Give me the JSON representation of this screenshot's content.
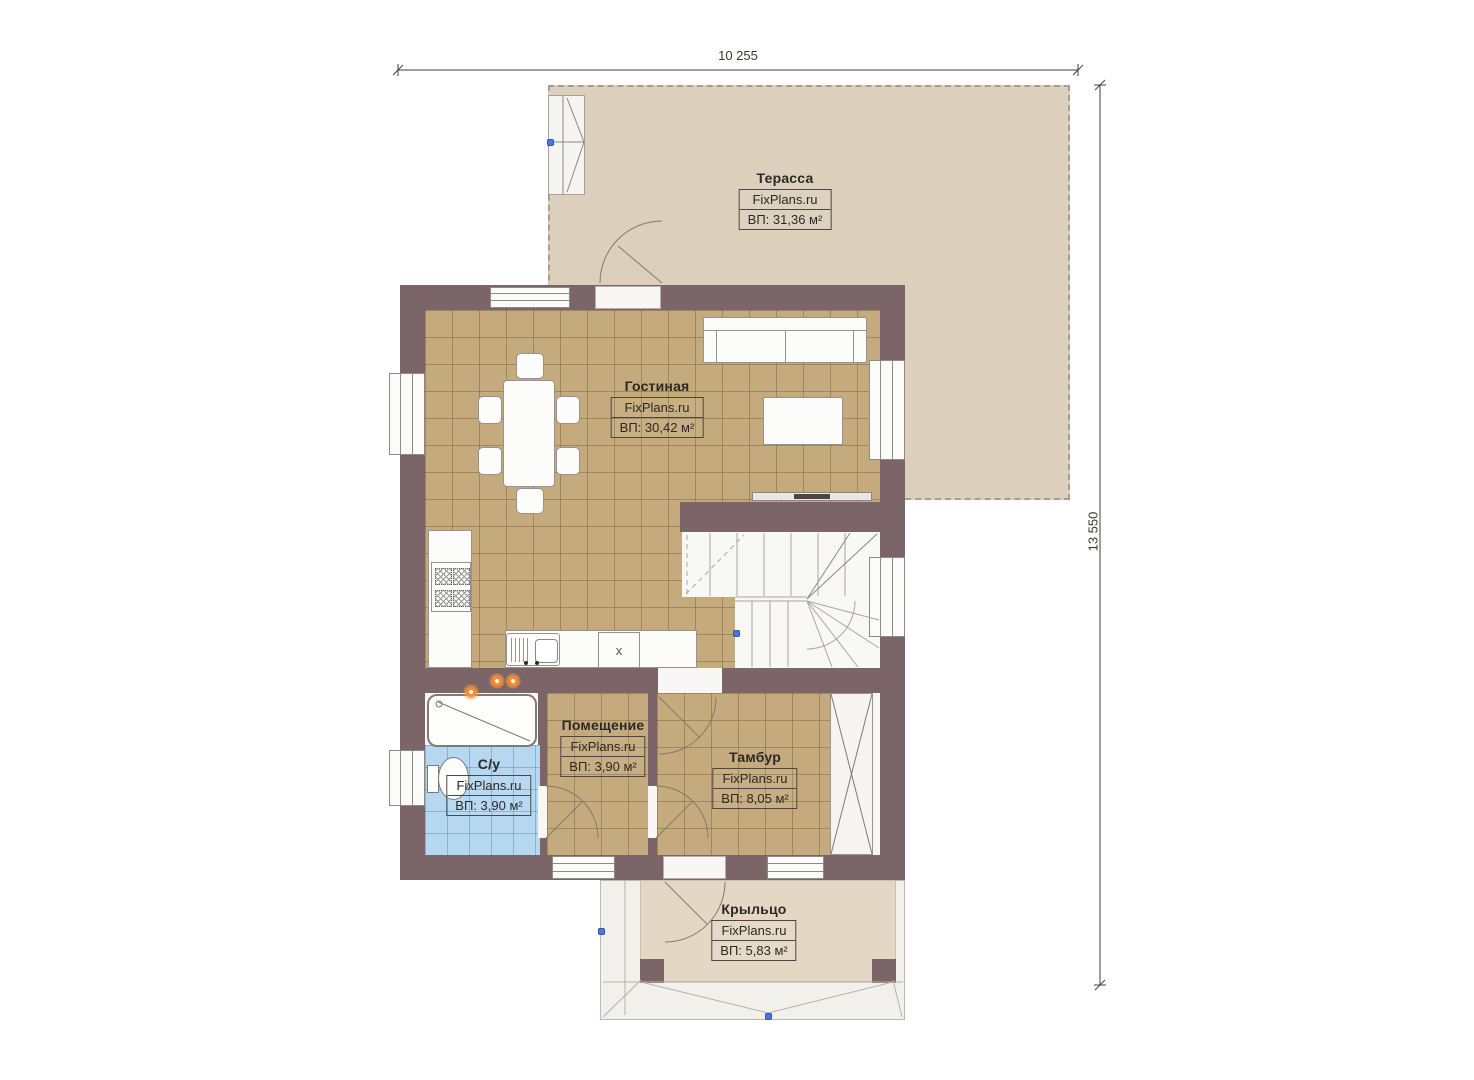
{
  "dimensions": {
    "top": "10 255",
    "right": "13 550"
  },
  "rooms": {
    "terrace": {
      "title": "Терасса",
      "brand": "FixPlans.ru",
      "area": "ВП: 31,36 м²"
    },
    "living": {
      "title": "Гостиная",
      "brand": "FixPlans.ru",
      "area": "ВП: 30,42 м²"
    },
    "utility": {
      "title": "Помещение",
      "brand": "FixPlans.ru",
      "area": "ВП: 3,90 м²"
    },
    "bathroom": {
      "title": "С/у",
      "brand": "FixPlans.ru",
      "area": "ВП: 3,90 м²"
    },
    "vestibule": {
      "title": "Тамбур",
      "brand": "FixPlans.ru",
      "area": "ВП: 8,05 м²"
    },
    "porch": {
      "title": "Крыльцо",
      "brand": "FixPlans.ru",
      "area": "ВП: 5,83 м²"
    }
  },
  "markers": {
    "appliance": "x"
  },
  "colors": {
    "wall": "#7c6568",
    "floor_tile": "#c4aa7d",
    "bathroom_tile": "#b5d7f0",
    "terrace": "#dcd0bc",
    "porch": "#e4d8c4",
    "accent_orange": "#ff8c2e",
    "marker_blue": "#4a79d9"
  }
}
